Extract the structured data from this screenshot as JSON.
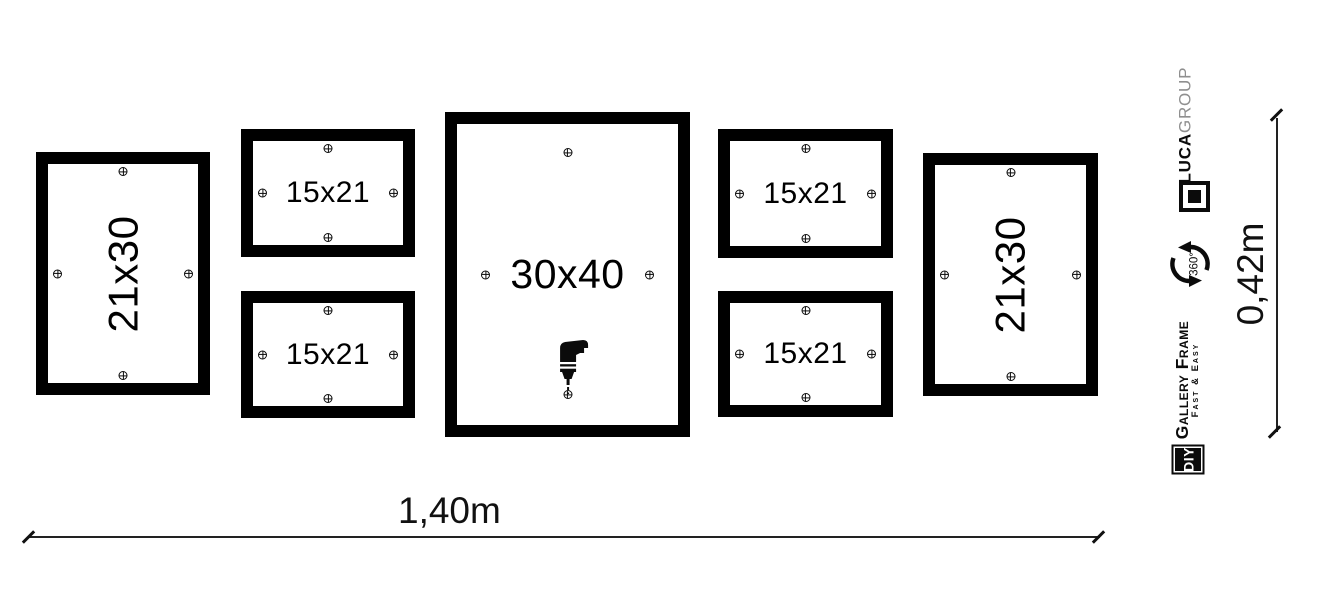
{
  "frames": [
    {
      "label": "21x30"
    },
    {
      "label": "15x21"
    },
    {
      "label": "15x21"
    },
    {
      "label": "30x40"
    },
    {
      "label": "15x21"
    },
    {
      "label": "15x21"
    },
    {
      "label": "21x30"
    }
  ],
  "dimensions": {
    "width_label": "1,40m",
    "height_label": "0,42m"
  },
  "branding": {
    "brand_bold": "LUCA",
    "brand_light": "GROUP",
    "rotation_label": "360°",
    "product_title": "Gallery Frame",
    "product_subtitle": "Fast & Easy",
    "diy_label": "DIY"
  },
  "icons": {
    "screw": "crosshair-screw",
    "drill": "power-drill",
    "rotation": "circular-arrows-360"
  },
  "colors": {
    "frame": "#000000",
    "text": "#000000",
    "brand_gray": "#8f8f8f",
    "line": "#222222",
    "background": "#ffffff"
  }
}
